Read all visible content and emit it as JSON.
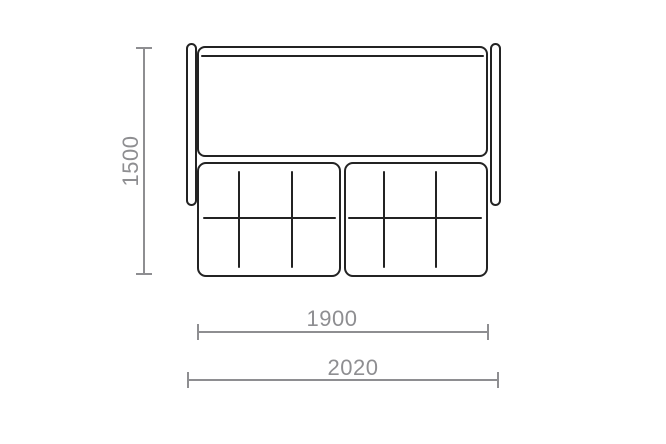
{
  "diagram": {
    "type": "furniture-dimension-drawing",
    "subject": "sofa-top-view",
    "dimensions": {
      "height_label": "1500",
      "seat_width_label": "1900",
      "overall_width_label": "2020"
    },
    "colors": {
      "outline": "#232323",
      "dimension_lines": "#8e8e91",
      "background": "#ffffff"
    }
  }
}
